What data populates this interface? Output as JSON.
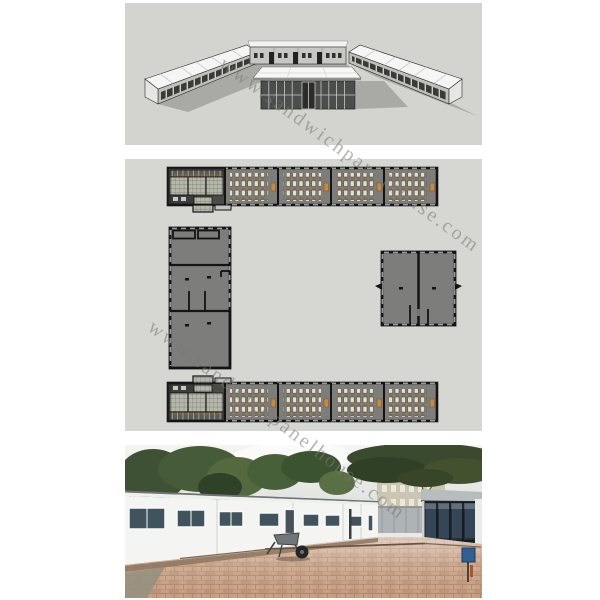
{
  "image": {
    "width": 600,
    "height": 600,
    "background": "#ffffff"
  },
  "watermark": {
    "text": "www.sandwichpanelhouse.com",
    "color": "#787875",
    "opacity": 0.55,
    "angle_deg_line1": 36,
    "angle_deg_line2": 37
  },
  "panels": {
    "render3d": {
      "label": "3d-site-render",
      "background": "#d3d3cf",
      "roof_color": "#f5f5f3",
      "wall_color": "#bfbfbc",
      "shadow_color": "#a9a9a6",
      "buildings": [
        "left-long-block",
        "back-classroom-row",
        "right-long-block",
        "center-glass-hall"
      ]
    },
    "floorplan": {
      "label": "site-floor-plan",
      "background": "#d6d6d2",
      "floor_color": "#7d7d7b",
      "wall_color": "#141414",
      "desk_color": "#e7e0c8",
      "chair_color": "#96672f",
      "teacher_desk_color": "#c28a46",
      "tile_color": "#b4b7aa",
      "buildings": [
        "top-classroom-strip",
        "left-hall-building",
        "right-twin-room-building",
        "bottom-classroom-strip"
      ],
      "classrooms_per_strip": 4
    },
    "photo": {
      "label": "site-photo",
      "sky_color": "#f0f2ef",
      "tree_color": "#3f5134",
      "prefab_wall_color": "#f4f5f3",
      "window_glass_color": "#41545e",
      "pavilion_glass_color": "#25303a",
      "paving_color": "#c29a7d",
      "sign_color": "#2f5f93",
      "elements": [
        "white-prefab-classroom-row",
        "glass-entrance-pavilion",
        "wheelbarrow",
        "paved-courtyard",
        "trees",
        "background-buildings",
        "site-fence",
        "blue-sign"
      ]
    }
  }
}
